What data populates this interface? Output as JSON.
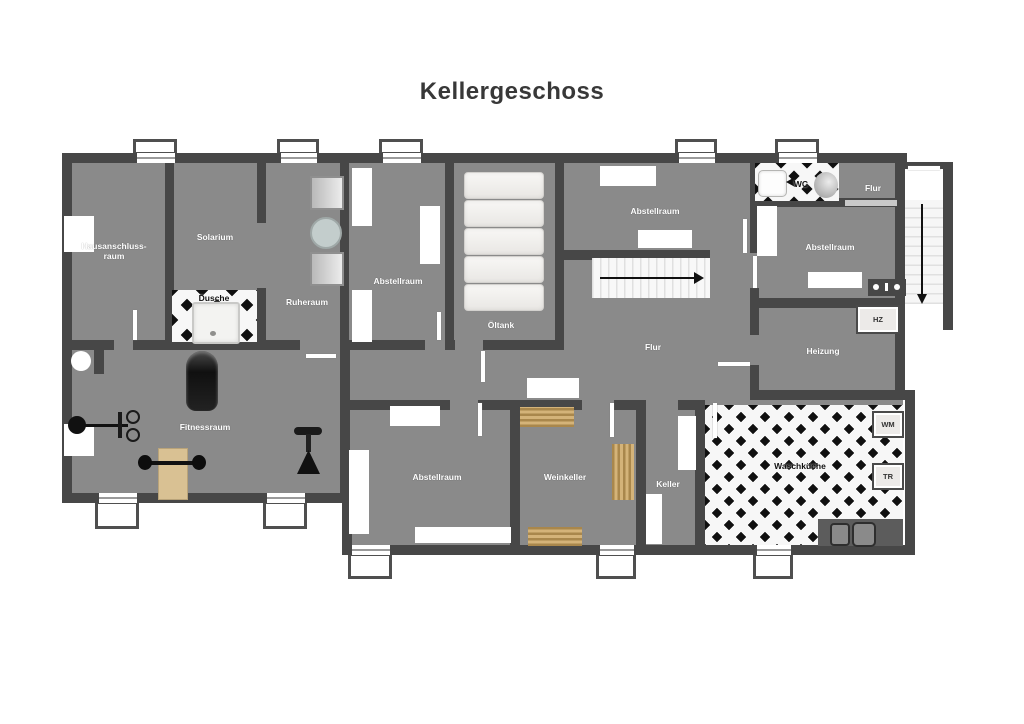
{
  "title": "Kellergeschoss",
  "colors": {
    "wall": "#474747",
    "floor": "#8a8a8a",
    "tile_black": "#101010",
    "tile_white": "#f7f7f7",
    "wood": "#c49e62",
    "title_text": "#383838"
  },
  "rooms": {
    "hausanschlussraum": {
      "label": "Hausanschluss-raum",
      "line1": "Hausanschluss-",
      "line2": "raum"
    },
    "solarium": {
      "label": "Solarium"
    },
    "dusche": {
      "label": "Dusche"
    },
    "ruheraum": {
      "label": "Ruheraum"
    },
    "abstellraum_top": {
      "label": "Abstellraum"
    },
    "oeltank": {
      "label": "Öltank"
    },
    "abstellraum_topright": {
      "label": "Abstellraum"
    },
    "wc": {
      "label": "WC"
    },
    "flur_top": {
      "label": "Flur"
    },
    "abstellraum_right": {
      "label": "Abstellraum"
    },
    "heizung": {
      "label": "Heizung"
    },
    "flur": {
      "label": "Flur"
    },
    "fitnessraum": {
      "label": "Fitnessraum"
    },
    "abstellraum_bottom": {
      "label": "Abstellraum"
    },
    "weinkeller": {
      "label": "Weinkeller"
    },
    "keller": {
      "label": "Keller"
    },
    "waschkueche": {
      "label": "Waschküche"
    }
  },
  "appliances": {
    "hz": {
      "label": "HZ"
    },
    "wm": {
      "label": "WM"
    },
    "tr": {
      "label": "TR"
    }
  }
}
